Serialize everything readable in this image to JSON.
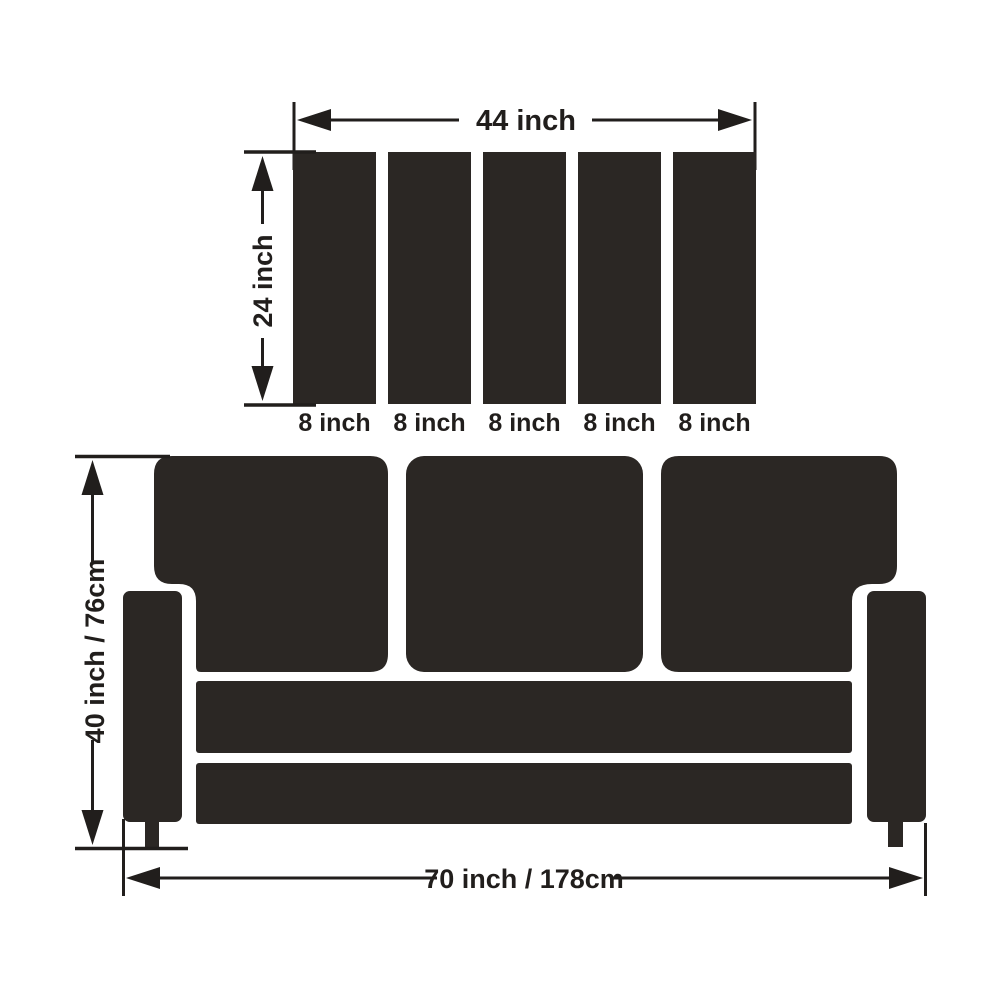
{
  "colors": {
    "background": "#ffffff",
    "shape_fill": "#2b2724",
    "line": "#211e1c"
  },
  "top_diagram": {
    "title": "back-cushion-slats-top-view",
    "width_label": "44 inch",
    "height_label": "24 inch",
    "slat_labels": [
      "8 inch",
      "8 inch",
      "8 inch",
      "8 inch",
      "8 inch"
    ]
  },
  "sofa_diagram": {
    "title": "sofa-front-view",
    "height_label": "40 inch / 76cm",
    "width_label": "70 inch / 178cm"
  }
}
